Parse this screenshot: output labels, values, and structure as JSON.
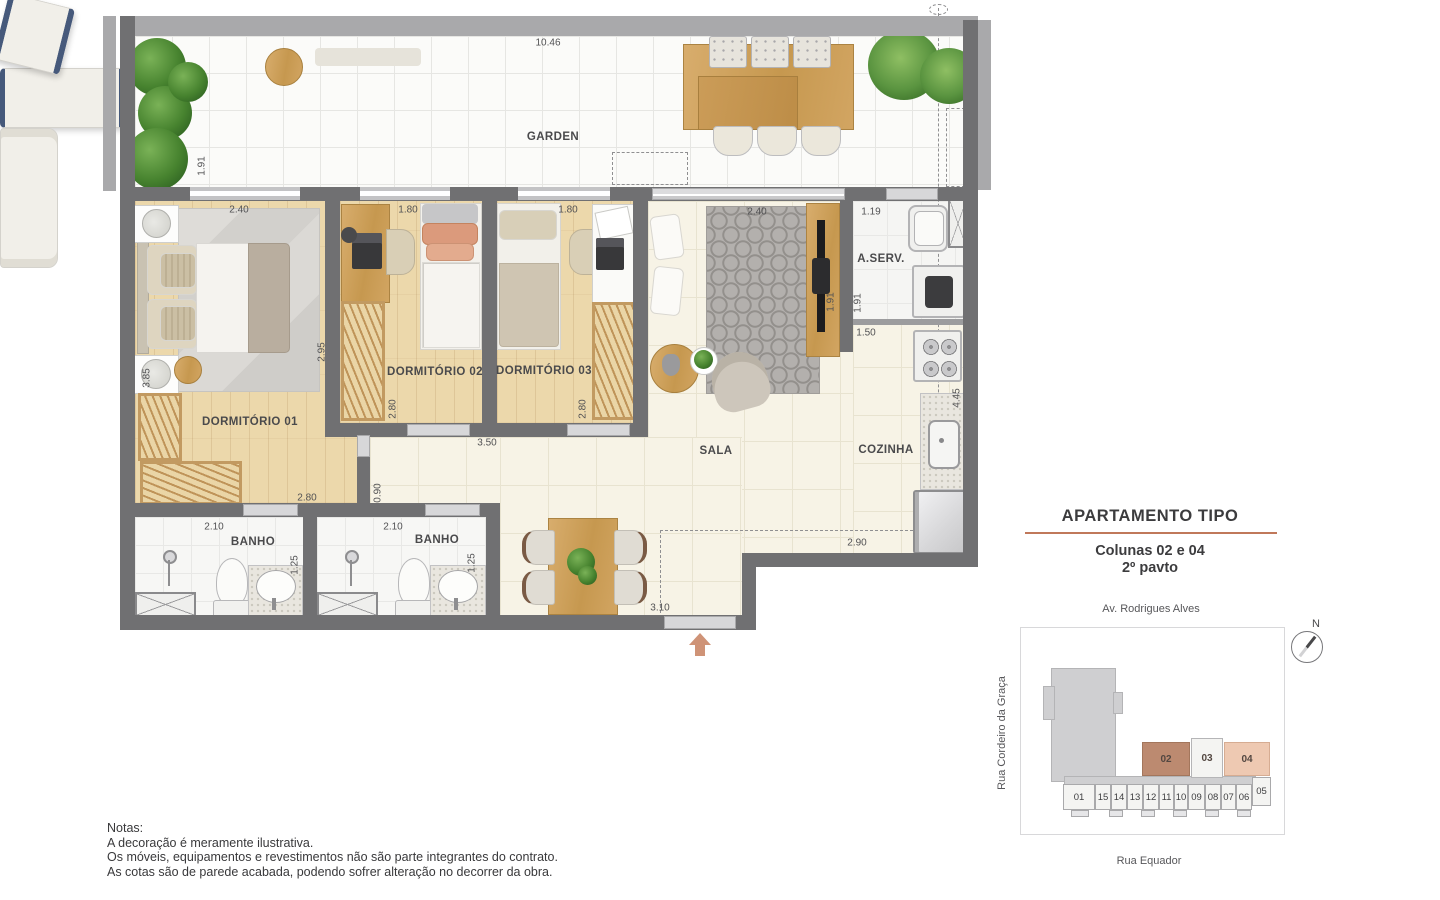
{
  "floor_plan": {
    "room_labels": {
      "garden": "GARDEN",
      "dorm1": "DORMITÓRIO 01",
      "dorm2": "DORMITÓRIO 02",
      "dorm3": "DORMITÓRIO 03",
      "sala": "SALA",
      "cozinha": "COZINHA",
      "aserv": "A.SERV.",
      "banho1": "BANHO",
      "banho2": "BANHO"
    },
    "dimensions": {
      "garden_width": "10.46",
      "garden_depth": "1.91",
      "dorm1_width": "2.40",
      "dorm2_width": "1.80",
      "dorm3_width": "1.80",
      "sala_width": "2.40",
      "aserv_width": "1.19",
      "dorm1_depth": "2.95",
      "dorm1_side": "3.85",
      "dorm1_bottom": "2.80",
      "dorm2_depth": "2.80",
      "dorm3_depth": "2.80",
      "sala_tv": "1.91",
      "aserv_depth": "1.91",
      "cozinha_top": "1.50",
      "cozinha_side": "4.45",
      "hall": "3.50",
      "hall_passage": "0.90",
      "banho1_width": "2.10",
      "banho1_side": "1.25",
      "banho2_width": "2.10",
      "banho2_side": "1.25",
      "entry": "3.10",
      "cozinha_bottom": "2.90"
    }
  },
  "info_panel": {
    "title": "APARTAMENTO TIPO",
    "subtitle_line1": "Colunas 02 e 04",
    "subtitle_line2": "2º pavto",
    "street_top": "Av. Rodrigues Alves",
    "street_left": "Rua Cordeiro da Graça",
    "street_bottom": "Rua Equador",
    "compass_label": "N",
    "site_map": {
      "highlight_units": {
        "u02": "02",
        "u03": "03",
        "u04": "04"
      },
      "row_units": [
        "01",
        "15",
        "14",
        "13",
        "12",
        "11",
        "10",
        "09",
        "08",
        "07",
        "06",
        "05"
      ]
    }
  },
  "notes": {
    "heading": "Notas:",
    "line1": "A decoração é meramente ilustrativa.",
    "line2": "Os móveis, equipamentos e revestimentos não são parte integrantes do contrato.",
    "line3": "As cotas são de parede acabada, podendo sofrer alteração no decorrer da obra."
  },
  "colors": {
    "wall": "#707072",
    "accent": "#c0785a",
    "unit02_fill": "#bc8a70",
    "unit04_fill": "#eec9b2"
  }
}
